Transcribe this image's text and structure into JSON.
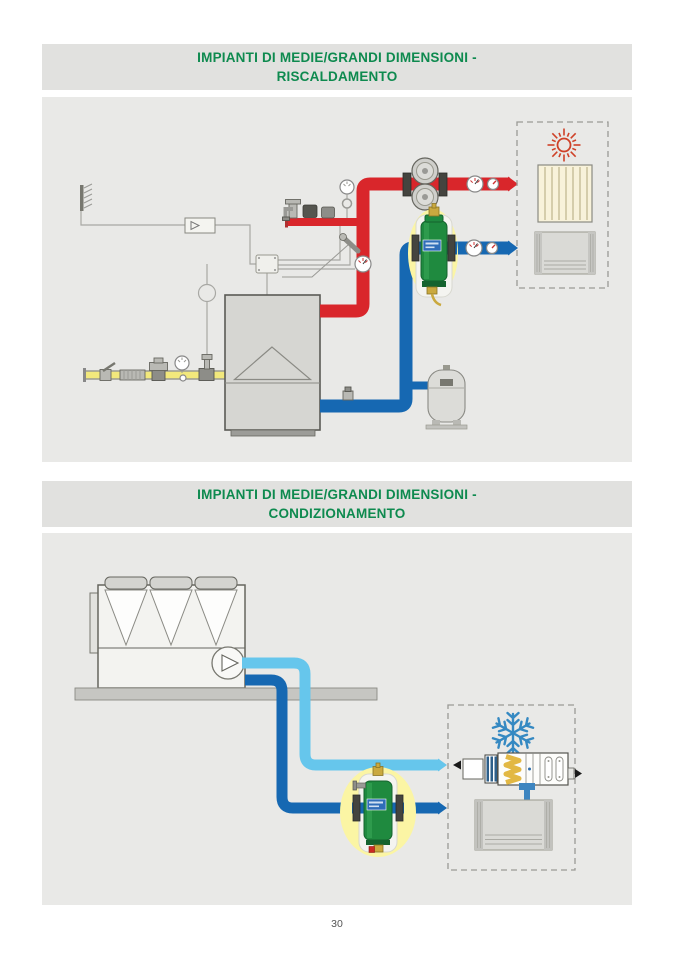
{
  "page": {
    "number": "30"
  },
  "sections": [
    {
      "id": "heating",
      "title_line1": "IMPIANTI DI MEDIE/GRANDI DIMENSIONI -",
      "title_line2": "RISCALDAMENTO"
    },
    {
      "id": "conditioning",
      "title_line1": "IMPIANTI DI MEDIE/GRANDI DIMENSIONI -",
      "title_line2": "CONDIZIONAMENTO"
    }
  ],
  "colors": {
    "header_green": "#0e8a4f",
    "header_bar_gray": "#e1e1df",
    "panel_gray": "#e9e9e7",
    "supply_red": "#d9262b",
    "return_blue": "#1668b2",
    "chilled_light_blue": "#66c6ec",
    "gas_yellow": "#f2e87c",
    "device_green": "#1f8a3f",
    "highlight_yellow": "#fbf5a4",
    "sun_red": "#cf4128",
    "snowflake_blue": "#3589c2"
  },
  "icons": {
    "heating_diagram": [
      "outdoor-sensor-icon",
      "controller-icon",
      "junction-box-icon",
      "boiler-icon",
      "burner-triangle-icon",
      "safety-relief-valve-icon",
      "pressure-switch-icon",
      "pressure-gauge-icon",
      "temperature-probe-icon",
      "thermometer-icon",
      "twin-pump-icon",
      "dirt-separator-icon",
      "expansion-vessel-icon",
      "gas-ball-valve-icon",
      "gas-flex-joint-icon",
      "gas-pressure-regulator-icon",
      "gas-solenoid-valve-icon",
      "sun-icon",
      "radiator-icon",
      "fan-coil-icon"
    ],
    "conditioning_diagram": [
      "chiller-icon",
      "pump-icon",
      "air-dirt-separator-icon",
      "snowflake-icon",
      "air-handling-unit-icon",
      "fan-coil-icon"
    ]
  }
}
